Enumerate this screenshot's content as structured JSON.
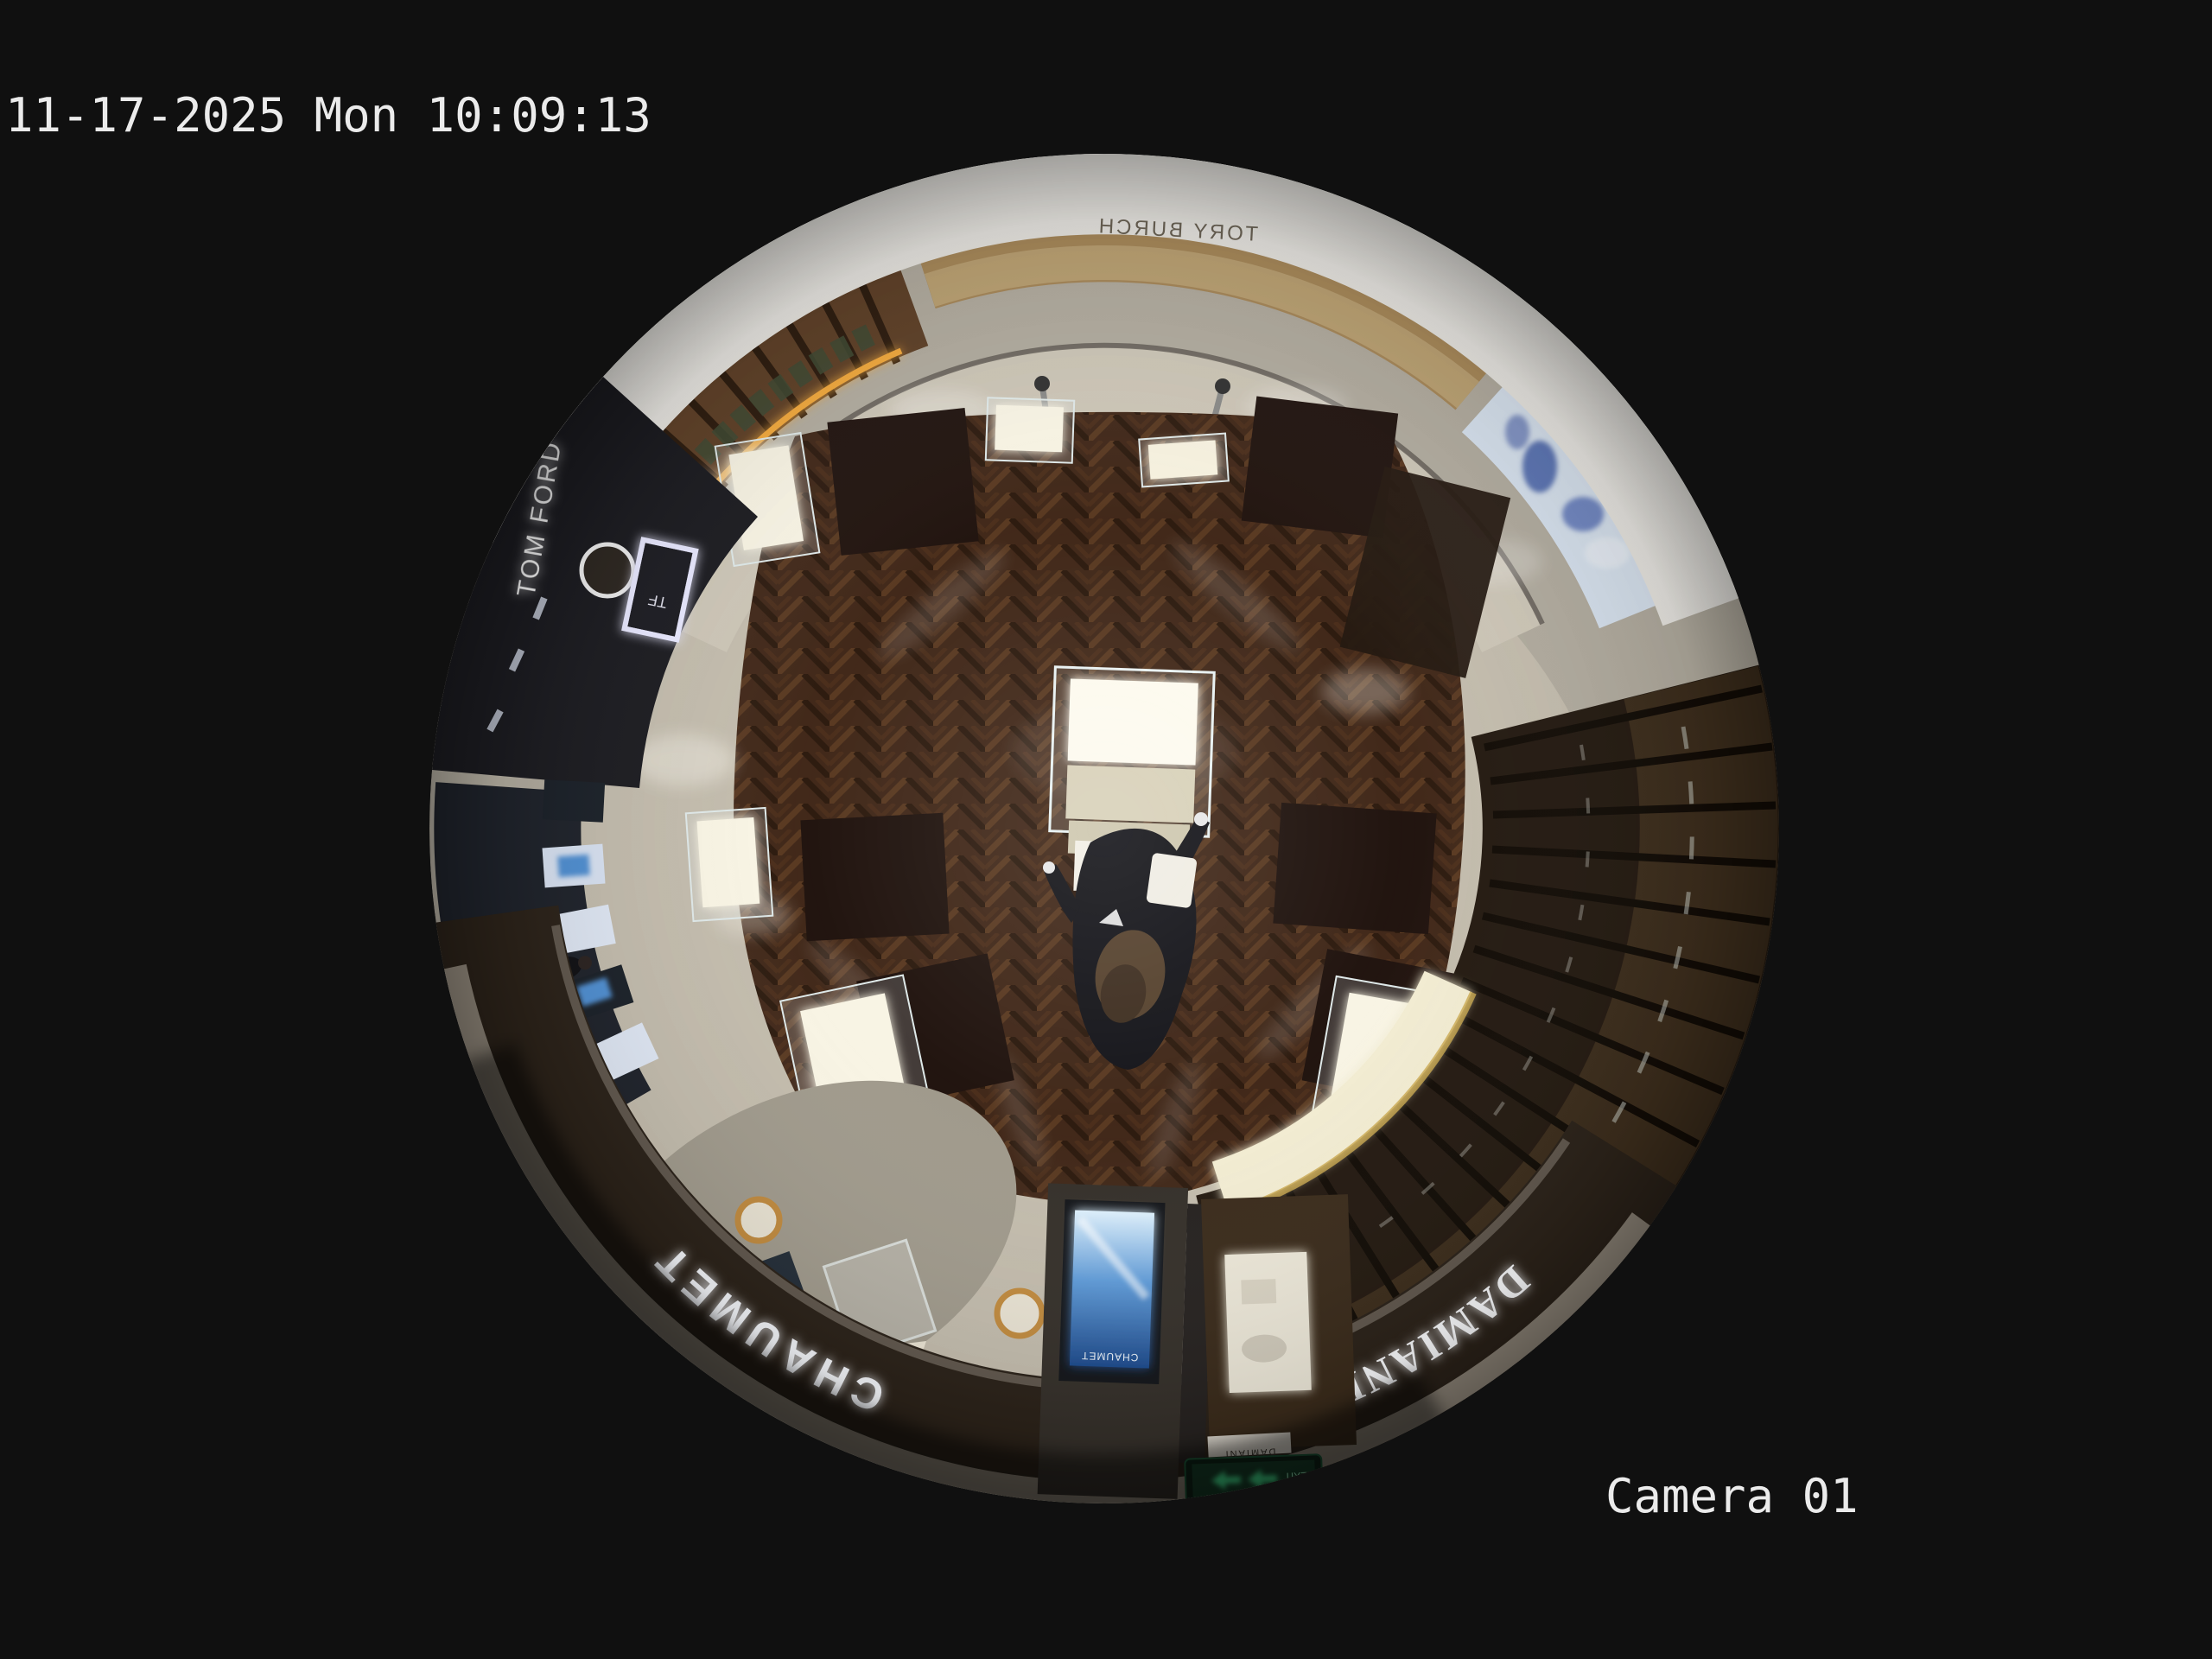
{
  "osd": {
    "timestamp": "11-17-2025 Mon 10:09:13",
    "camera_label": "Camera 01",
    "text_color": "#ebebeb"
  },
  "scene": {
    "view": "overhead 360-degree fisheye CCTV frame of a luxury jewelry boutique facing a mall corridor",
    "people_visible": 2,
    "signs": {
      "boutique_left": "CHAUMET",
      "boutique_right": "DAMIANI",
      "neighbor_store": "TOM FORD",
      "neighbor_store_logo": "TF",
      "corridor_store": "TORY BURCH",
      "totem_screen": "CHAUMET",
      "exit_sign": "EXIT",
      "counter_small": "DAMIANI",
      "cosmetics_counter": "LA MER"
    },
    "colors": {
      "background": "#101010",
      "wood_floor": "#42291a",
      "tile_floor": "#c3bcad",
      "marble_corridor": "#b2ac9f",
      "ceiling_ring": "#e9e7e2",
      "fascia_band": "#2b2219",
      "gold_wall": "#a8895a",
      "led_strip": "#f2a93e",
      "screen_blue": "#5f9bd8",
      "exit_green": "#45e892",
      "sign_glow": "#f5f7fb"
    }
  }
}
